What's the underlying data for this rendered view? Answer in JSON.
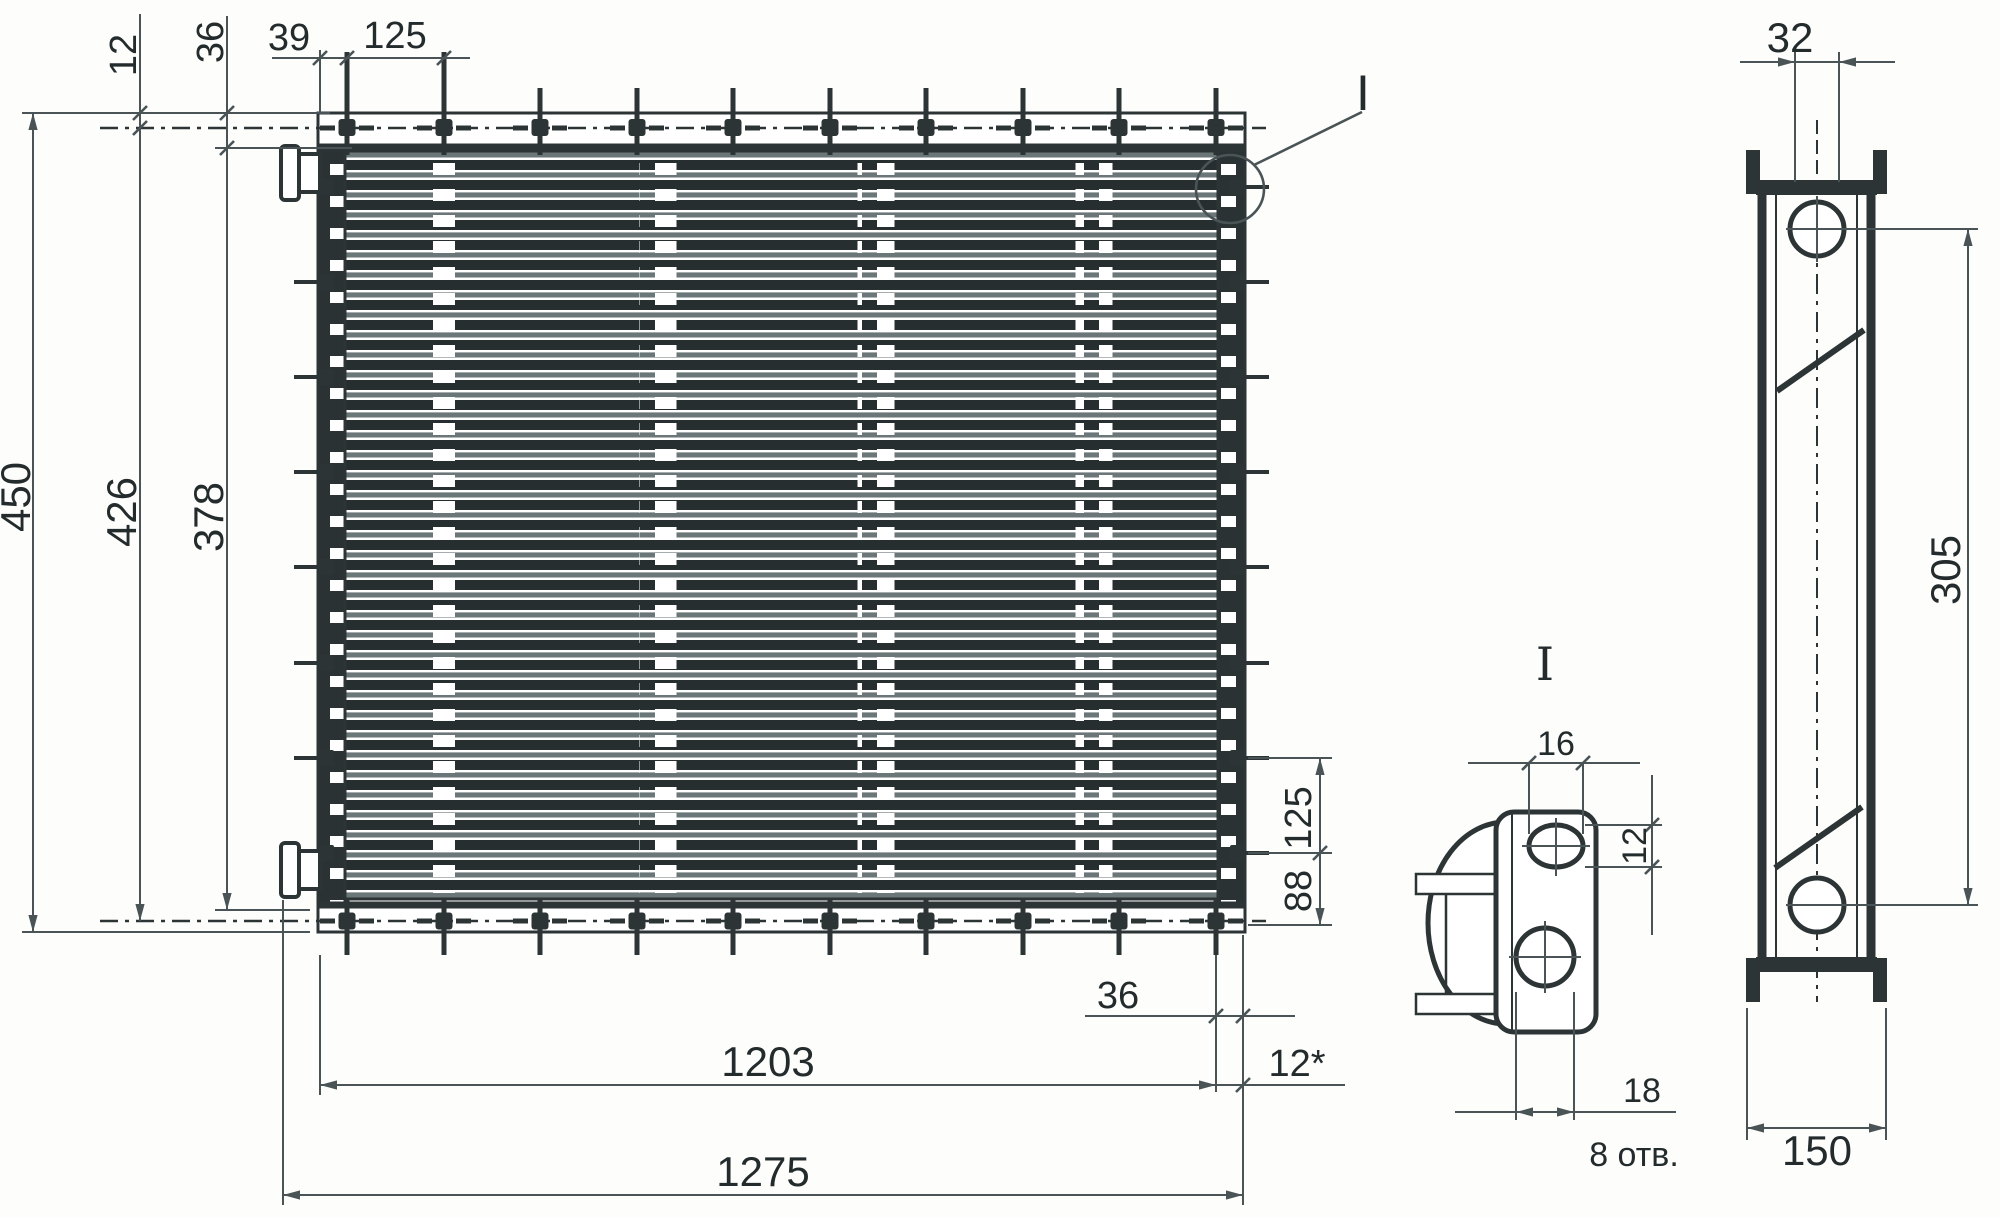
{
  "drawing": {
    "type_note": "technical drawing of finned tube heat exchanger, three views",
    "front_view": {
      "overall_height": "450",
      "bolt_line_height": "426",
      "core_height": "378",
      "rail_offset": "12",
      "edge_margin": "36",
      "stud_edge_offset": "39",
      "stud_pitch": "125",
      "right_side_pitch": "125",
      "right_side_bottom_margin": "88",
      "bottom_stud_margin": "36",
      "bottom_reference": "12*",
      "bolt_frame_width": "1203",
      "overall_width": "1275",
      "detail_callout_label": "I"
    },
    "side_view": {
      "tube_width": "32",
      "hole_spacing": "305",
      "overall_depth": "150"
    },
    "detail_view": {
      "title": "I",
      "slot_width": "16",
      "slot_height": "12",
      "hole_diameter": "18",
      "holes_note": "8 отв."
    }
  }
}
